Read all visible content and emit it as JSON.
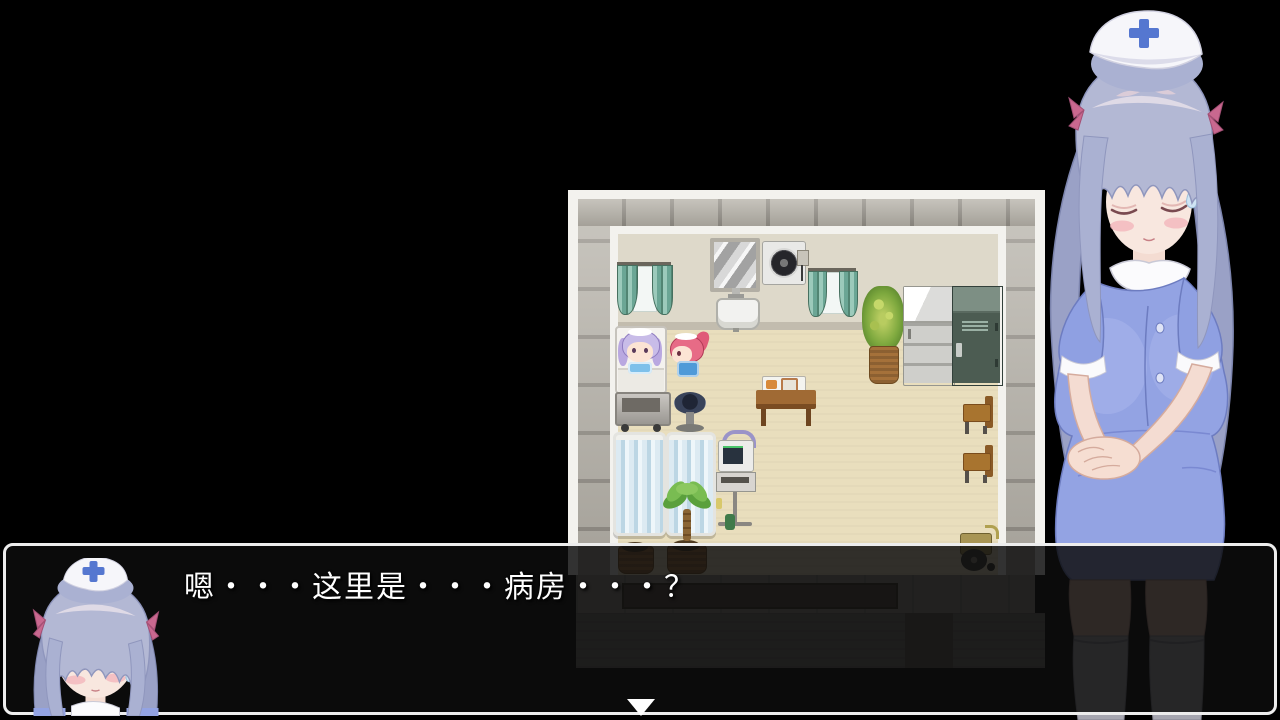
{
  "scene": {
    "background_color": "#000000",
    "type": "rpg-visual-novel"
  },
  "dialogue": {
    "text": "嗯・・・这里是・・・病房・・・？",
    "speaker_portrait": "nurse-face",
    "continue_indicator": "down-triangle",
    "box_border_color": "#ededed",
    "box_background": "rgba(13,13,13,0.84)",
    "text_color": "#ffffff"
  },
  "map": {
    "setting": "hospital-ward-room",
    "objects": [
      "window-curtains-left",
      "mirror",
      "wall-sink",
      "exhaust-fan",
      "window-curtains-right",
      "tall-potted-plant",
      "refrigerator",
      "green-locker",
      "hospital-bed",
      "round-stool",
      "privacy-screen-1",
      "privacy-screen-2",
      "palm-plant",
      "medical-monitor-stand",
      "meal-table-with-tray",
      "wooden-chair-1",
      "wooden-chair-2",
      "flower-pot",
      "wheelchair",
      "south-doorway"
    ],
    "characters": [
      "maid-purple-hair-in-bed",
      "maid-pink-hair-standing"
    ]
  },
  "characters": {
    "nurse": {
      "pose": "standing, eyes closed, hands clasped",
      "hair_color": "#b3b8d4",
      "dress_color": "#93a3e3",
      "cap_cross_color": "#5577d0",
      "ribbon_color": "#c9688f"
    }
  },
  "colors": {
    "floor": "#e9debd",
    "room_wall": "#ded9ca",
    "outer_wall": "#b7b3aa",
    "white_trim": "#f3f2ee",
    "curtain": "#6ba695",
    "locker": "#4c5c52",
    "corridor": "#726e69"
  },
  "icons": {
    "continue-arrow-icon": "▼",
    "nurse-cap-cross": "+"
  }
}
